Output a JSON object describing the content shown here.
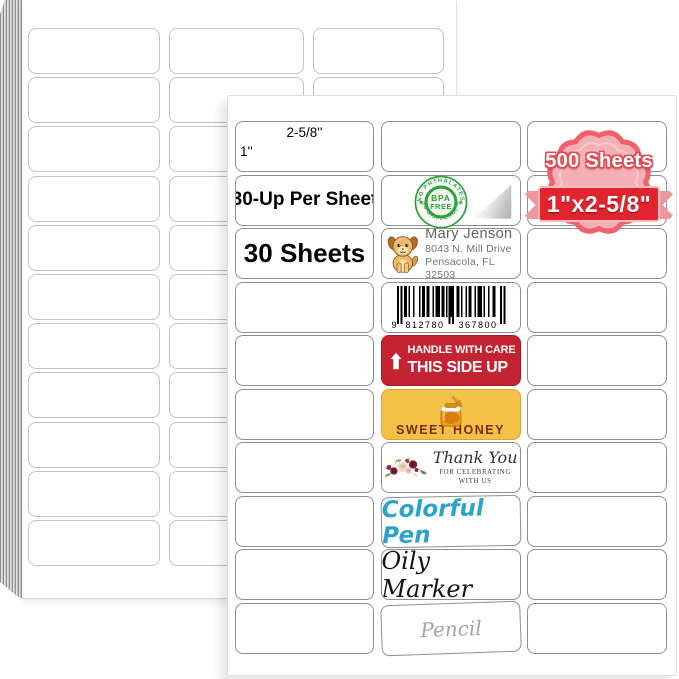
{
  "front_sheet": {
    "width_annotation": "2-5/8''",
    "height_annotation": "1''",
    "label_30up": "30-Up Per Sheet",
    "label_30sheets": "30 Sheets"
  },
  "badge": {
    "sheets_text": "500 Sheets",
    "size_text": "1\"x2-5/8\""
  },
  "bpa_seal": {
    "arc_top": "NO PHTHALATES",
    "arc_bottom": "NO BISPHENOL A",
    "center_top": "BPA",
    "center_bottom": "FREE"
  },
  "address_label": {
    "name": "Mary Jenson",
    "address_line1": "8043 N. Mill Drive",
    "address_line2": "Pensacola, FL 32503"
  },
  "barcode_label": {
    "digit_lead": "9",
    "digit_group1": "812780",
    "digit_group2": "367800"
  },
  "handling_label": {
    "line1": "HANDLE WITH CARE",
    "line2": "THIS SIDE UP"
  },
  "honey_label": {
    "text": "SWEET HONEY"
  },
  "thank_you_label": {
    "script_text": "Thank You",
    "sub_line1": "FOR CELEBRATING",
    "sub_line2": "WITH US"
  },
  "pen_label": {
    "text": "Colorful Pen"
  },
  "marker_label": {
    "text": "Oily Marker"
  },
  "pencil_label": {
    "text": "Pencil"
  },
  "colors": {
    "handling_red": "#c42431",
    "honey_yellow": "#f3c145",
    "honey_text_brown": "#7c2a0d",
    "seal_green": "#2da23a",
    "pen_blue": "#2ba3cc",
    "pencil_gray": "#a5a5a5",
    "badge_pink_fill": "#f5b0b6",
    "badge_border_salmon": "#ee616d",
    "ribbon_red": "#e2242e"
  }
}
